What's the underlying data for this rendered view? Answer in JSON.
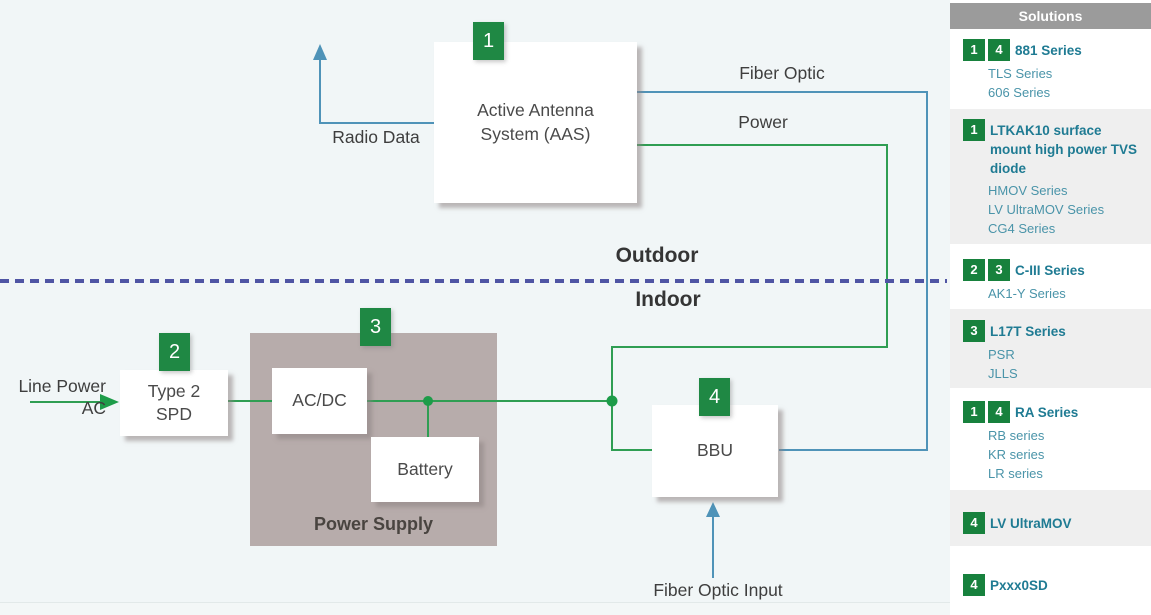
{
  "colors": {
    "badge_green": "#1f8844",
    "sidebar_badge_green": "#17813d",
    "line_green": "#2f9e53",
    "line_blue": "#4f93b8",
    "divider_purple": "#4f55a4",
    "panel_header_gray": "#9b9b9b",
    "row_alt_gray": "#efefef",
    "link_teal_bold": "#1f7b93",
    "link_teal": "#4a94a9",
    "power_supply_gray": "#b7acab",
    "diagram_bg": "#f1f6f7"
  },
  "diagram": {
    "labels": {
      "radio_data": "Radio Data",
      "fiber_optic": "Fiber Optic",
      "power": "Power",
      "outdoor": "Outdoor",
      "indoor": "Indoor",
      "line_power_line1": "Line Power",
      "line_power_line2": "AC",
      "fiber_optic_input": "Fiber Optic Input"
    },
    "nodes": {
      "aas": {
        "badge": "1",
        "line1": "Active Antenna",
        "line2": "System (AAS)"
      },
      "spd": {
        "badge": "2",
        "line1": "Type 2",
        "line2": "SPD"
      },
      "power_supply": {
        "badge": "3",
        "label": "Power Supply"
      },
      "acdc": {
        "label": "AC/DC"
      },
      "battery": {
        "label": "Battery"
      },
      "bbu": {
        "badge": "4",
        "label": "BBU"
      }
    }
  },
  "sidebar": {
    "header": "Solutions",
    "rows": [
      {
        "badges": [
          "1",
          "4"
        ],
        "title": "881 Series",
        "items": [
          "TLS Series",
          "606 Series"
        ]
      },
      {
        "badges": [
          "1"
        ],
        "title": "LTKAK10 surface mount high power TVS diode",
        "items": [
          "HMOV Series",
          "LV UltraMOV Series",
          "CG4 Series"
        ]
      },
      {
        "badges": [
          "2",
          "3"
        ],
        "title": "C-III Series",
        "items": [
          "AK1-Y Series"
        ]
      },
      {
        "badges": [
          "3"
        ],
        "title": "L17T Series",
        "items": [
          "PSR",
          "JLLS"
        ]
      },
      {
        "badges": [
          "1",
          "4"
        ],
        "title": "RA Series",
        "items": [
          "RB series",
          "KR series",
          "LR series"
        ]
      },
      {
        "badges": [
          "4"
        ],
        "title": "LV UltraMOV",
        "items": []
      },
      {
        "badges": [
          "4"
        ],
        "title": "Pxxx0SD",
        "items": []
      }
    ]
  }
}
